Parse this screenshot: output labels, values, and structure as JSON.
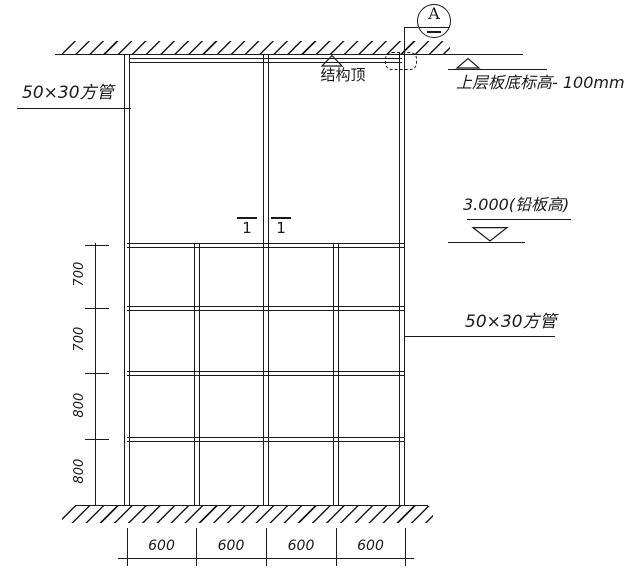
{
  "labels": {
    "left_tube": "50×30方管",
    "right_tube": "50×30方管",
    "structure_top": "结构顶",
    "upper_slab_elevation": "上层板底标高- 100mm",
    "lead_plate_elevation": "3.000(铅板高)",
    "detail_bubble": "A",
    "section_mark": "1"
  },
  "dims": {
    "vertical": [
      "700",
      "700",
      "800",
      "800"
    ],
    "horizontal": [
      "600",
      "600",
      "600",
      "600"
    ]
  },
  "colors": {
    "line": "#1a1a1a",
    "background": "#ffffff"
  }
}
